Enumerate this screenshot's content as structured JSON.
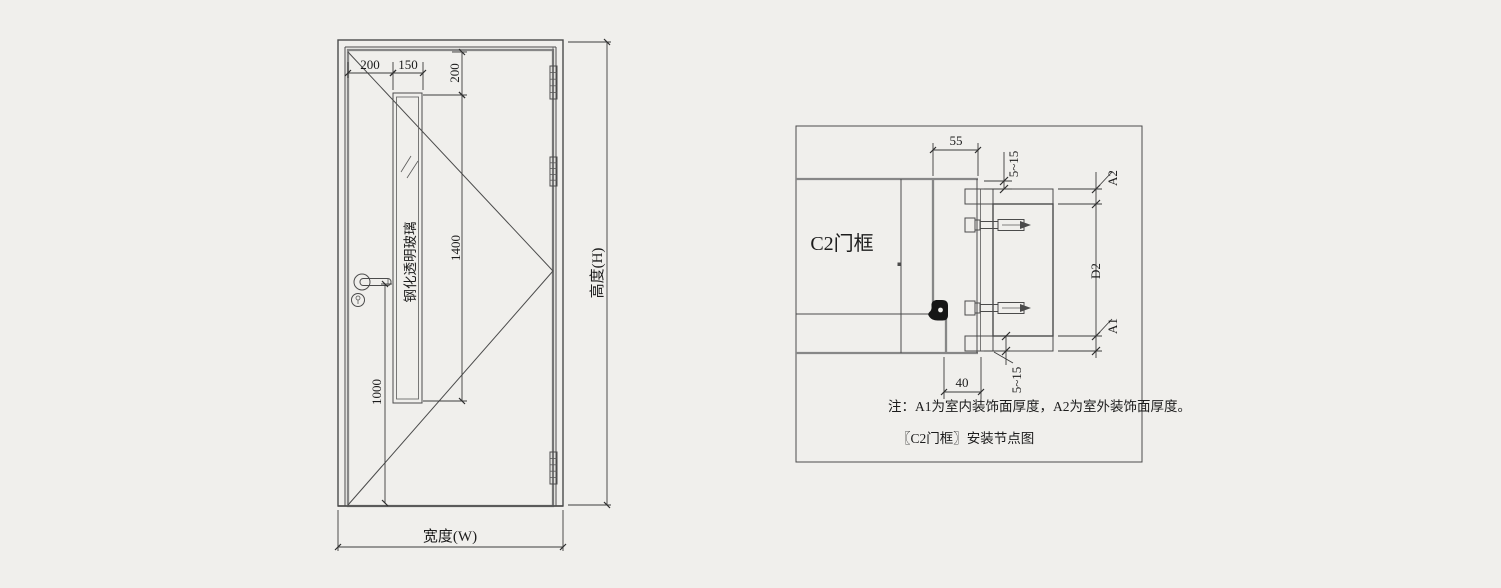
{
  "drawing": {
    "background": "#f0efec",
    "line_color": "#4b4b4b",
    "text_color": "#1c1c1c"
  },
  "elevation": {
    "glass_label": "钢化透明玻璃",
    "dims": {
      "left_offset": "200",
      "glass_width": "150",
      "top_offset": "200",
      "glass_height": "1400",
      "handle_height": "1000",
      "width_label": "宽度(W)",
      "height_label": "高度(H)"
    }
  },
  "detail": {
    "frame_label": "C2门框",
    "dims": {
      "frame_depth": "55",
      "frame_back": "40",
      "gap_top": "5~15",
      "gap_bottom": "5~15",
      "a2": "A2",
      "d2": "D2",
      "a1": "A1"
    },
    "note": "注：A1为室内装饰面厚度，A2为室外装饰面厚度。",
    "title": "〖C2门框〗安装节点图"
  }
}
